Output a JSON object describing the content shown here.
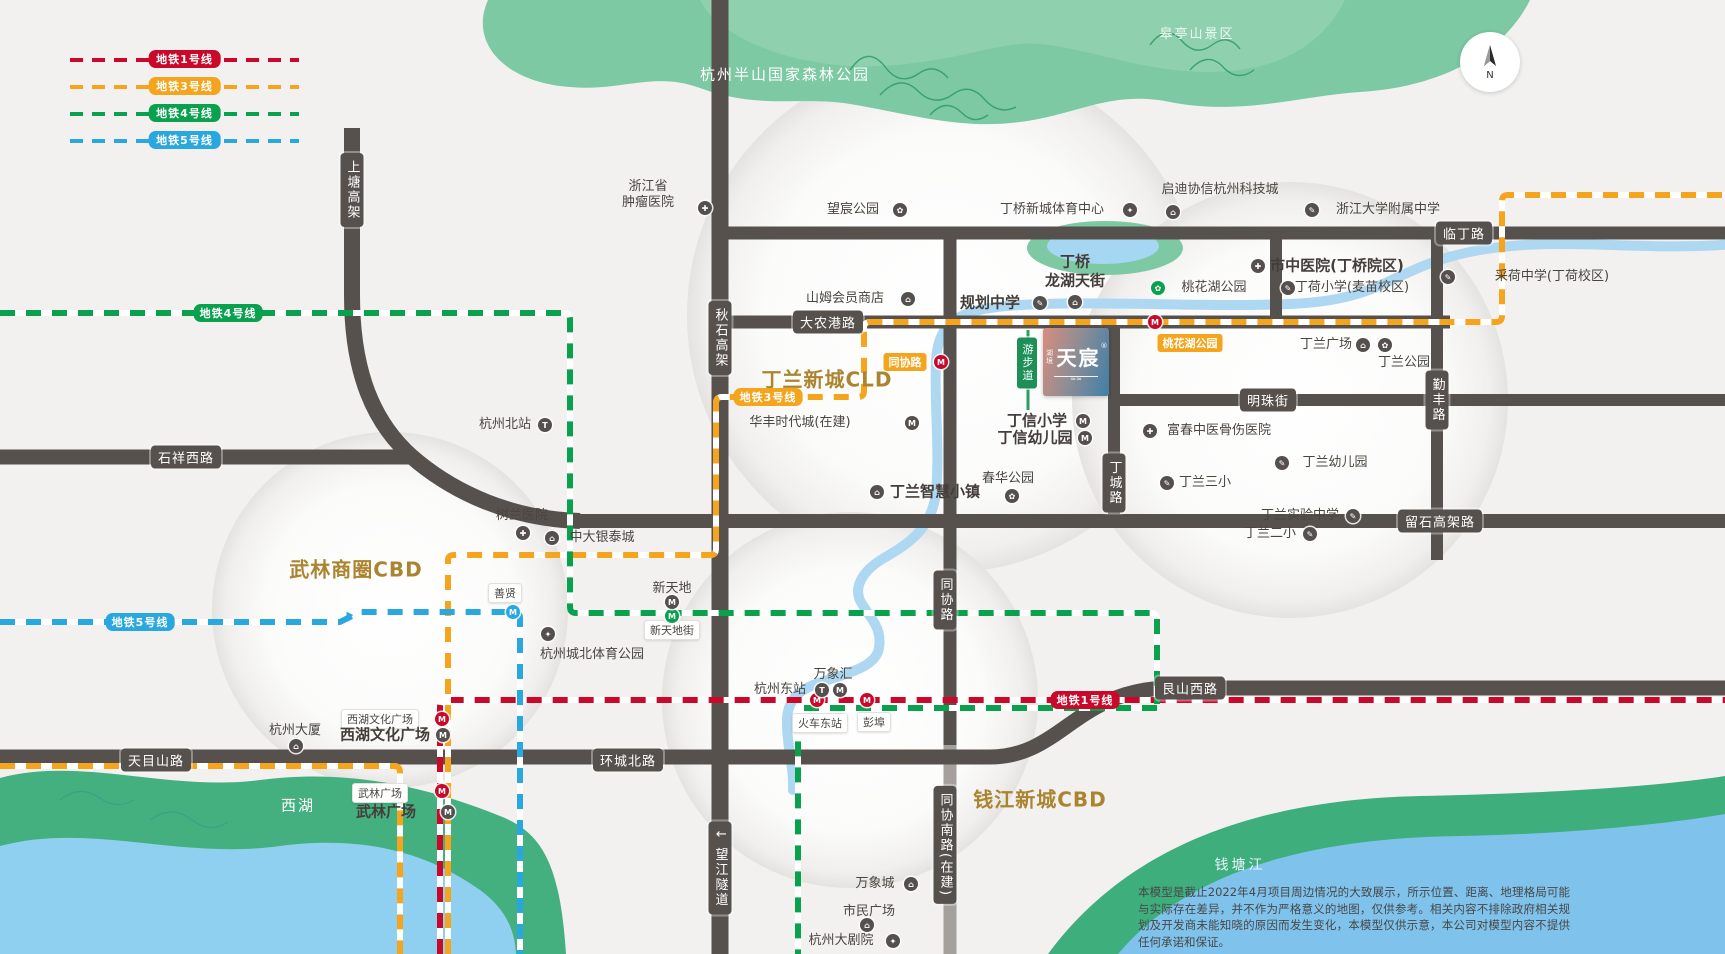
{
  "colors": {
    "line1": "#c9082a",
    "line3": "#f4a41d",
    "line4": "#0aa14e",
    "line5": "#29a8e0",
    "road": "#57514e",
    "gold": "#ab8430",
    "river": "#aed7f2",
    "park_green": "#7cc9a4"
  },
  "legend": {
    "items": [
      {
        "label": "地铁1号线",
        "line": "line1"
      },
      {
        "label": "地铁3号线",
        "line": "line3"
      },
      {
        "label": "地铁4号线",
        "line": "line4"
      },
      {
        "label": "地铁5号线",
        "line": "line5"
      }
    ]
  },
  "compass": {
    "north": "N"
  },
  "project": {
    "prefix": "湖境",
    "name": "天宸",
    "mark": "®",
    "wave": "≈≈"
  },
  "disclaimer": "本模型是截止2022年4月项目周边情况的大致展示，所示位置、距离、地理格局可能与实际存在差异，并不作为严格意义的地图，仅供参考。相关内容不排除政府相关规划及开发商未能知晓的原因而发生变化，本模型仅供示意，本公司对模型内容不提供任何承诺和保证。",
  "map": {
    "walkway_label": "游步道",
    "area_labels": [
      {
        "t": "杭州半山国家森林公园",
        "x": 785,
        "y": 75,
        "cls": "t-area"
      },
      {
        "t": "皋亭山景区",
        "x": 1197,
        "y": 35,
        "cls": "t-area-sm"
      },
      {
        "t": "西湖",
        "x": 298,
        "y": 806,
        "cls": "t-area"
      },
      {
        "t": "钱塘江",
        "x": 1240,
        "y": 866,
        "cls": "t-river"
      }
    ],
    "cbd_labels": [
      {
        "t": "丁兰新城CLD",
        "x": 827,
        "y": 380
      },
      {
        "t": "武林商圈CBD",
        "x": 356,
        "y": 570
      },
      {
        "t": "钱江新城CBD",
        "x": 1040,
        "y": 800
      }
    ],
    "road_labels": [
      {
        "t": "上塘高架",
        "x": 352,
        "y": 190,
        "v": true
      },
      {
        "t": "临丁路",
        "x": 1464,
        "y": 233
      },
      {
        "t": "大农港路",
        "x": 828,
        "y": 322
      },
      {
        "t": "石祥西路",
        "x": 186,
        "y": 457
      },
      {
        "t": "秋石高架",
        "x": 720,
        "y": 338,
        "v": true
      },
      {
        "t": "明珠街",
        "x": 1268,
        "y": 400
      },
      {
        "t": "丁城路",
        "x": 1114,
        "y": 483,
        "v": true
      },
      {
        "t": "勤丰路",
        "x": 1437,
        "y": 400,
        "v": true
      },
      {
        "t": "留石高架路",
        "x": 1440,
        "y": 521
      },
      {
        "t": "同协路",
        "x": 945,
        "y": 600,
        "v": true
      },
      {
        "t": "同协南路(在建)",
        "x": 945,
        "y": 845,
        "v": true
      },
      {
        "t": "天目山路",
        "x": 156,
        "y": 760
      },
      {
        "t": "环城北路",
        "x": 628,
        "y": 760
      },
      {
        "t": "艮山西路",
        "x": 1190,
        "y": 688
      },
      {
        "t": "↓ 望江隧道",
        "x": 720,
        "y": 868,
        "v": true
      }
    ],
    "metro": {
      "line_labels": [
        {
          "t": "地铁1号线",
          "line": "line1",
          "x": 1085,
          "y": 700
        },
        {
          "t": "地铁3号线",
          "line": "line3",
          "x": 768,
          "y": 397
        },
        {
          "t": "地铁4号线",
          "line": "line4",
          "x": 228,
          "y": 313
        },
        {
          "t": "地铁5号线",
          "line": "line5",
          "x": 140,
          "y": 622
        }
      ],
      "orange_pills": [
        {
          "t": "同协路",
          "x": 905,
          "y": 362
        },
        {
          "t": "桃花湖公园",
          "x": 1190,
          "y": 343
        }
      ],
      "station_pills": [
        {
          "t": "新天地街",
          "x": 672,
          "y": 630
        },
        {
          "t": "善贤",
          "x": 505,
          "y": 593
        },
        {
          "t": "西湖文化广场",
          "x": 380,
          "y": 719
        },
        {
          "t": "武林广场",
          "x": 380,
          "y": 793
        },
        {
          "t": "火车东站",
          "x": 820,
          "y": 723
        },
        {
          "t": "彭埠",
          "x": 874,
          "y": 722
        }
      ],
      "icons": [
        {
          "x": 941,
          "y": 362,
          "c": "red",
          "g": "M"
        },
        {
          "x": 1155,
          "y": 322,
          "c": "red",
          "g": "M"
        },
        {
          "x": 442,
          "y": 719,
          "c": "red",
          "g": "M"
        },
        {
          "x": 442,
          "y": 791,
          "c": "red",
          "g": "M"
        },
        {
          "x": 817,
          "y": 700,
          "c": "red",
          "g": "M"
        },
        {
          "x": 867,
          "y": 700,
          "c": "red",
          "g": "M"
        },
        {
          "x": 513,
          "y": 612,
          "c": "blue",
          "g": "M"
        },
        {
          "x": 672,
          "y": 616,
          "c": "green",
          "g": "M"
        }
      ]
    },
    "pois": [
      {
        "t": "浙江省\n肿瘤医院",
        "x": 648,
        "y": 195
      },
      {
        "t": "望宸公园",
        "x": 853,
        "y": 210
      },
      {
        "t": "丁桥新城体育中心",
        "x": 1052,
        "y": 210
      },
      {
        "t": "启迪协信杭州科技城",
        "x": 1220,
        "y": 190
      },
      {
        "t": "浙江大学附属中学",
        "x": 1388,
        "y": 210
      },
      {
        "t": "市中医院(丁桥院区)",
        "x": 1337,
        "y": 266,
        "cls": "t-poi-big"
      },
      {
        "t": "丁荷小学(麦苗校区)",
        "x": 1352,
        "y": 288
      },
      {
        "t": "采荷中学(丁荷校区)",
        "x": 1552,
        "y": 277
      },
      {
        "t": "桃花湖公园",
        "x": 1214,
        "y": 288
      },
      {
        "t": "山姆会员商店",
        "x": 845,
        "y": 299
      },
      {
        "t": "规划中学",
        "x": 990,
        "y": 303,
        "cls": "t-poi-big"
      },
      {
        "t": "丁桥\n龙湖天街",
        "x": 1075,
        "y": 271,
        "cls": "t-poi-big"
      },
      {
        "t": "丁信小学",
        "x": 1037,
        "y": 421,
        "cls": "t-poi-big"
      },
      {
        "t": "丁信幼儿园",
        "x": 1035,
        "y": 438,
        "cls": "t-poi-big"
      },
      {
        "t": "春华公园",
        "x": 1008,
        "y": 479
      },
      {
        "t": "富春中医骨伤医院",
        "x": 1219,
        "y": 431
      },
      {
        "t": "丁兰三小",
        "x": 1205,
        "y": 483
      },
      {
        "t": "丁兰幼儿园",
        "x": 1335,
        "y": 463
      },
      {
        "t": "丁兰实验中学",
        "x": 1300,
        "y": 516
      },
      {
        "t": "丁兰二小",
        "x": 1270,
        "y": 534
      },
      {
        "t": "丁兰智慧小镇",
        "x": 935,
        "y": 492,
        "cls": "t-poi-big"
      },
      {
        "t": "华丰时代城(在建)",
        "x": 800,
        "y": 423
      },
      {
        "t": "杭州北站",
        "x": 505,
        "y": 425
      },
      {
        "t": "树兰医院",
        "x": 522,
        "y": 516
      },
      {
        "t": "中大银泰城",
        "x": 602,
        "y": 538
      },
      {
        "t": "新天地",
        "x": 672,
        "y": 589
      },
      {
        "t": "杭州城北体育公园",
        "x": 592,
        "y": 655
      },
      {
        "t": "万象汇",
        "x": 833,
        "y": 675
      },
      {
        "t": "杭州东站",
        "x": 780,
        "y": 690
      },
      {
        "t": "西湖文化广场",
        "x": 385,
        "y": 735,
        "cls": "t-poi-big"
      },
      {
        "t": "杭州大厦",
        "x": 295,
        "y": 731
      },
      {
        "t": "武林广场",
        "x": 386,
        "y": 812,
        "cls": "t-poi-big"
      },
      {
        "t": "万象城",
        "x": 875,
        "y": 884
      },
      {
        "t": "市民广场",
        "x": 869,
        "y": 912
      },
      {
        "t": "杭州大剧院",
        "x": 841,
        "y": 941
      },
      {
        "t": "丁兰广场",
        "x": 1326,
        "y": 345
      },
      {
        "t": "丁兰公园",
        "x": 1404,
        "y": 363
      },
      {
        "t": "▶",
        "x": 350,
        "y": 616,
        "cls": "t-arrow"
      }
    ],
    "poi_icons": [
      {
        "x": 705,
        "y": 208,
        "g": "✚"
      },
      {
        "x": 900,
        "y": 210,
        "g": "✿"
      },
      {
        "x": 1130,
        "y": 210,
        "g": "✦"
      },
      {
        "x": 1173,
        "y": 212,
        "g": "⌂"
      },
      {
        "x": 1312,
        "y": 210,
        "g": "✎"
      },
      {
        "x": 1258,
        "y": 266,
        "g": "✚"
      },
      {
        "x": 1288,
        "y": 288,
        "g": "✎"
      },
      {
        "x": 1448,
        "y": 277,
        "g": "✎"
      },
      {
        "x": 1158,
        "y": 288,
        "g": "✿",
        "c": "green"
      },
      {
        "x": 908,
        "y": 299,
        "g": "⌂"
      },
      {
        "x": 1040,
        "y": 303,
        "g": "✎"
      },
      {
        "x": 1075,
        "y": 302,
        "g": "⌂"
      },
      {
        "x": 1083,
        "y": 421,
        "g": "M"
      },
      {
        "x": 1085,
        "y": 438,
        "g": "M"
      },
      {
        "x": 1012,
        "y": 496,
        "g": "✿"
      },
      {
        "x": 1150,
        "y": 431,
        "g": "✚"
      },
      {
        "x": 1167,
        "y": 483,
        "g": "✎"
      },
      {
        "x": 1282,
        "y": 463,
        "g": "✎"
      },
      {
        "x": 1353,
        "y": 516,
        "g": "✎"
      },
      {
        "x": 1310,
        "y": 534,
        "g": "✎"
      },
      {
        "x": 877,
        "y": 492,
        "g": "⌂"
      },
      {
        "x": 912,
        "y": 423,
        "g": "M"
      },
      {
        "x": 545,
        "y": 425,
        "g": "T"
      },
      {
        "x": 523,
        "y": 533,
        "g": "✚"
      },
      {
        "x": 552,
        "y": 538,
        "g": "⌂"
      },
      {
        "x": 548,
        "y": 634,
        "g": "✦"
      },
      {
        "x": 822,
        "y": 690,
        "g": "T"
      },
      {
        "x": 840,
        "y": 690,
        "g": "M"
      },
      {
        "x": 443,
        "y": 735,
        "g": "M"
      },
      {
        "x": 296,
        "y": 746,
        "g": "⌂"
      },
      {
        "x": 448,
        "y": 812,
        "g": "M"
      },
      {
        "x": 911,
        "y": 884,
        "g": "⌂"
      },
      {
        "x": 867,
        "y": 925,
        "g": "⌂"
      },
      {
        "x": 893,
        "y": 941,
        "g": "✦"
      },
      {
        "x": 1363,
        "y": 345,
        "g": "⌂"
      },
      {
        "x": 1385,
        "y": 345,
        "g": "✿"
      },
      {
        "x": 672,
        "y": 602,
        "g": "M"
      }
    ]
  }
}
